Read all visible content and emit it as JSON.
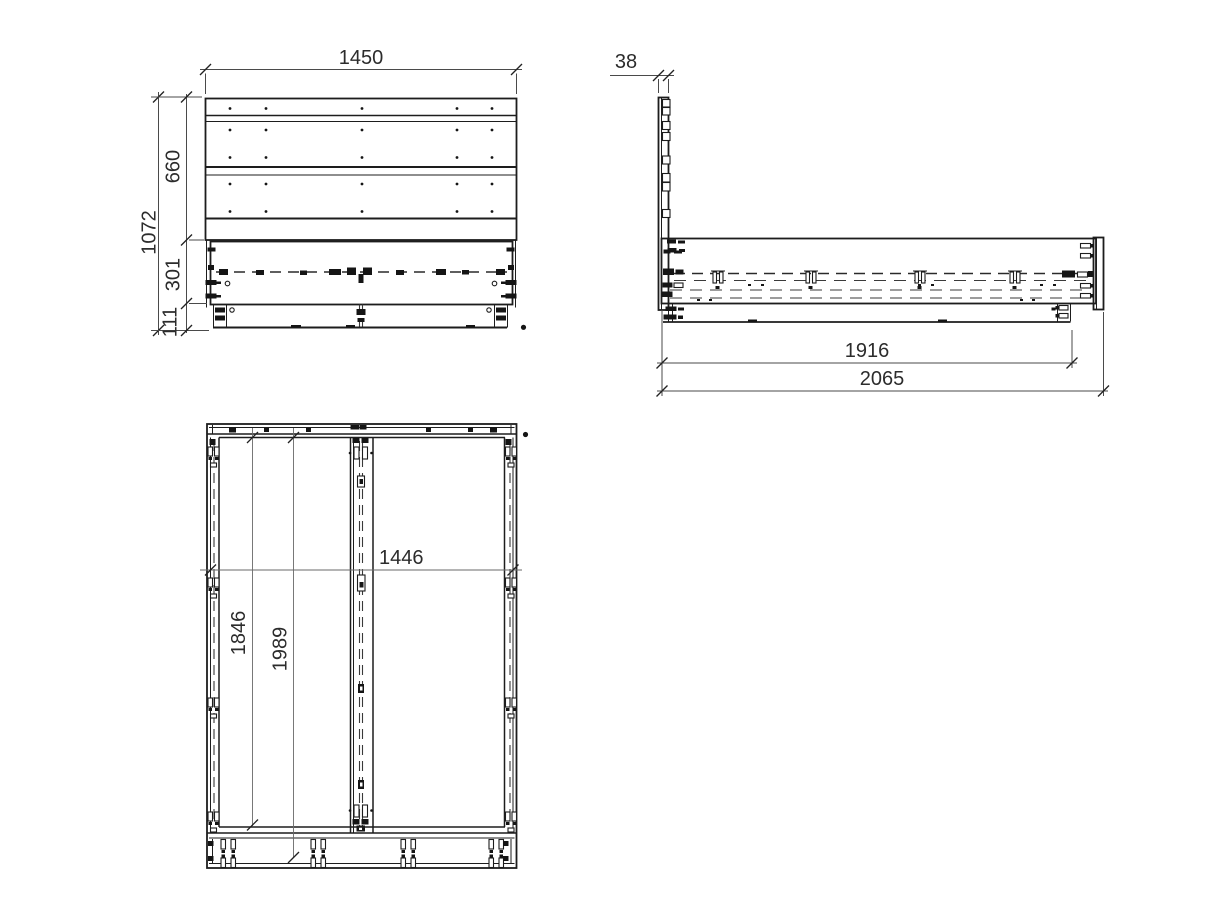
{
  "document": {
    "type": "technical-drawing",
    "subject": "bed frame with headboard, three orthographic views",
    "background_color": "#ffffff",
    "line_color": "#1d1d1d",
    "dimension_text_color": "#2c2c2c"
  },
  "views": {
    "front": {
      "dimensions": {
        "width_mm": "1450",
        "total_height_mm": "1072",
        "headboard_height_mm": "660",
        "rail_height_mm": "301",
        "base_height_mm": "111"
      }
    },
    "side": {
      "dimensions": {
        "headboard_thickness_mm": "38",
        "frame_length_mm": "1916",
        "total_length_mm": "2065"
      }
    },
    "plan": {
      "dimensions": {
        "inner_width_mm": "1446",
        "inner_length_mm": "1846",
        "length_with_headboard_mm": "1989"
      }
    }
  }
}
